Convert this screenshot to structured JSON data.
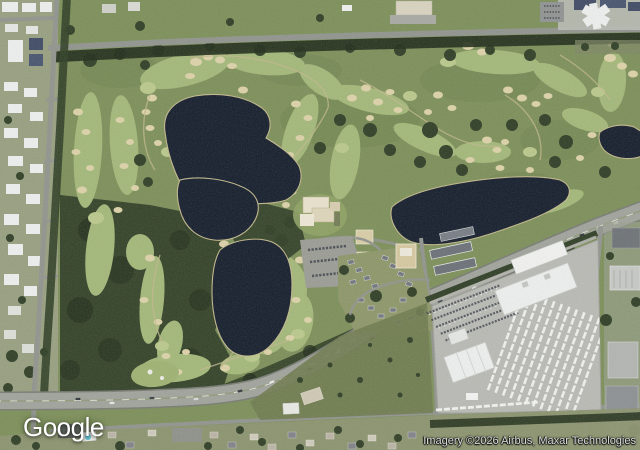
{
  "map": {
    "view": "Satellite aerial view of a golf course community with lakes, a curving highway, a truck depot and residential neighborhoods",
    "labels": {
      "logo": "Google",
      "attribution": "Imagery ©2026 Airbus, Maxar Technologies"
    }
  },
  "palette": {
    "grass": "#7c8f58",
    "grass-dark": "#697f4b",
    "fairway": "#a3b878",
    "green-bright": "#bac98b",
    "tree": "#2e3d24",
    "tree-dark": "#1f2b18",
    "water": "#131c2b",
    "shore": "#c2b88c",
    "sand": "#ddd2a8",
    "road": "#90948d",
    "road-light": "#a0a39b",
    "pavement": "#b9bab4",
    "roof-white": "#eef0ef",
    "scrub": "#6e7a4e",
    "res-base": "#9aa184"
  }
}
